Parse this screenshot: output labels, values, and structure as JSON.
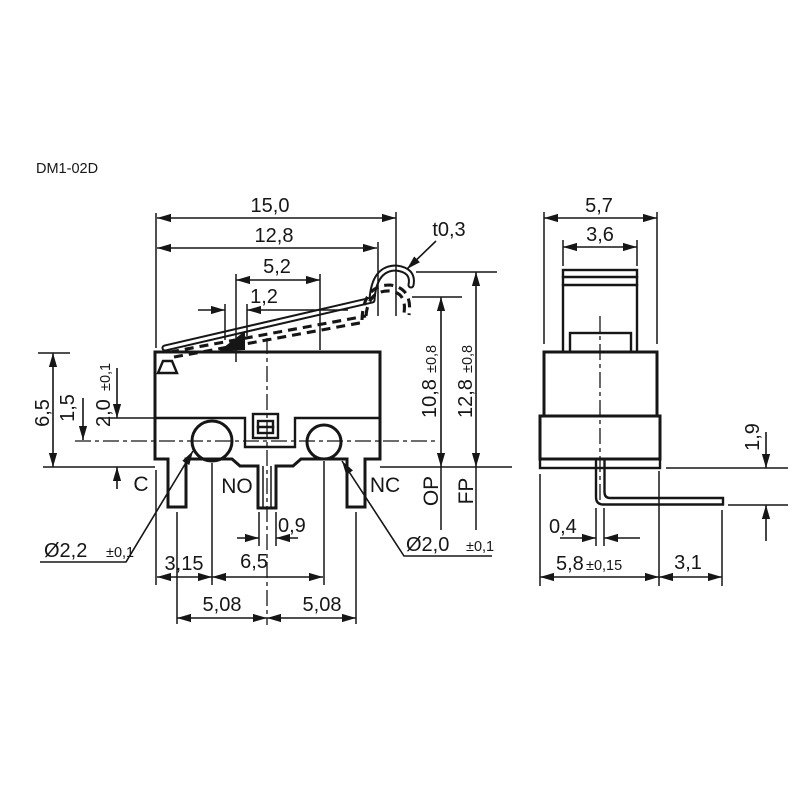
{
  "colors": {
    "line_color": "#161616",
    "background": "#ffffff"
  },
  "drawing": {
    "title": "DM1-02D"
  },
  "front_view": {
    "dims": {
      "overall_length": "15,0",
      "lever_free_length": "12,8",
      "lever_mid": "5,2",
      "hinge_width": "1,2",
      "lever_thickness": "t0,3",
      "body_height": "6,5",
      "centerline_height": "1,5",
      "step_height_main": "2,0",
      "step_height_tol": "±0,1",
      "op_height_main": "10,8",
      "op_height_tol": "±0,8",
      "fp_height_main": "12,8",
      "fp_height_tol": "±0,8",
      "terminal_thickness": "0,9",
      "hole_offset": "3,15",
      "hole_spacing": "6,5",
      "terminal_pitch_left": "5,08",
      "terminal_pitch_right": "5,08",
      "hole_left_dia_main": "Ø2,2",
      "hole_left_dia_tol": "±0,1",
      "hole_right_dia_main": "Ø2,0",
      "hole_right_dia_tol": "±0,1"
    },
    "labels": {
      "common": "C",
      "normally_open": "NO",
      "normally_closed": "NC",
      "operating_position": "OP",
      "free_position": "FP"
    }
  },
  "side_view": {
    "dims": {
      "body_width": "5,7",
      "lever_width": "3,6",
      "terminal_drop": "1,9",
      "terminal_thickness": "0,4",
      "body_depth_main": "5,8",
      "body_depth_tol": "±0,15",
      "terminal_extension": "3,1"
    }
  }
}
